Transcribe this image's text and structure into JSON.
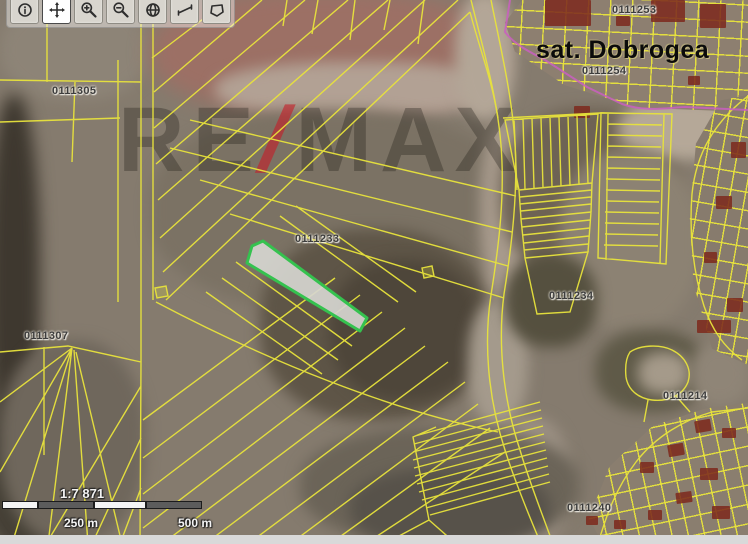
{
  "app": {
    "type": "cadastral-map-viewer"
  },
  "toolbar": {
    "buttons": [
      {
        "name": "identify"
      },
      {
        "name": "pan",
        "active": true
      },
      {
        "name": "zoom-in"
      },
      {
        "name": "zoom-out"
      },
      {
        "name": "full-extent"
      },
      {
        "name": "measure-distance"
      },
      {
        "name": "measure-area"
      }
    ]
  },
  "map": {
    "village_label": "sat. Dobrogea",
    "labels": [
      {
        "text": "0111305"
      },
      {
        "text": "0111307"
      },
      {
        "text": "0111233"
      },
      {
        "text": "0111253"
      },
      {
        "text": "0111254"
      },
      {
        "text": "0111234"
      },
      {
        "text": "0111214"
      },
      {
        "text": "0111240"
      }
    ],
    "selected_parcel": {
      "id": "0111233",
      "stroke": "#35c24f",
      "fill": "#d6d6d0"
    },
    "parcel_line_color": "#e8e33c",
    "intravilan_boundary_color": "#c95fc0"
  },
  "scale": {
    "ratio": "1:7 871",
    "mid_label": "250 m",
    "end_label": "500 m"
  },
  "watermark": {
    "part1": "RE",
    "slash": "/",
    "part2": "MAX"
  }
}
